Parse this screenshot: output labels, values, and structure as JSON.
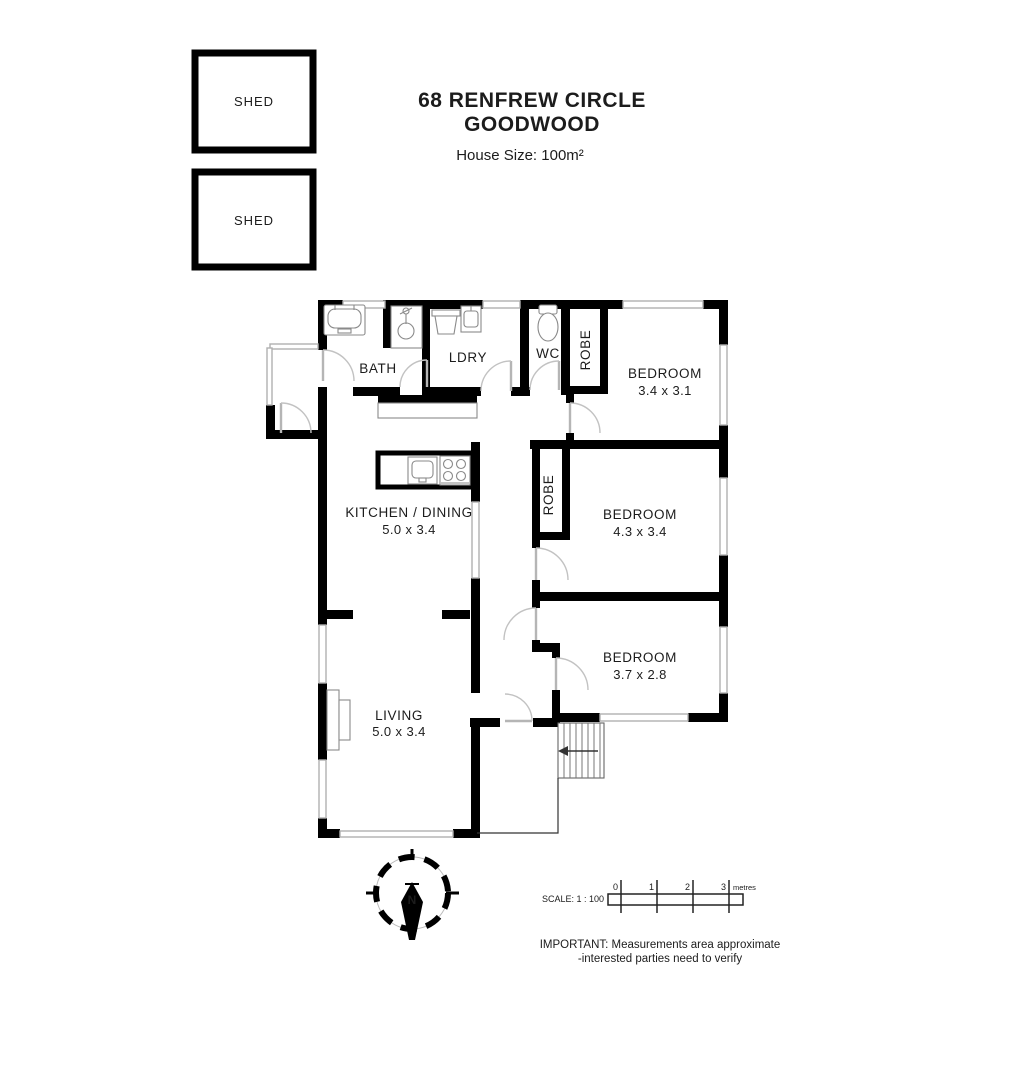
{
  "header": {
    "title_line1": "68 RENFREW CIRCLE",
    "title_line2": "GOODWOOD",
    "house_size": "House Size: 100m²"
  },
  "sheds": [
    {
      "label": "SHED"
    },
    {
      "label": "SHED"
    }
  ],
  "rooms": {
    "bath": {
      "label": "BATH"
    },
    "laundry": {
      "label": "LDRY"
    },
    "wc": {
      "label": "WC"
    },
    "robe1": {
      "label": "ROBE"
    },
    "robe2": {
      "label": "ROBE"
    },
    "bedroom1": {
      "label": "BEDROOM",
      "dims": "3.4 x 3.1"
    },
    "bedroom2": {
      "label": "BEDROOM",
      "dims": "4.3 x 3.4"
    },
    "bedroom3": {
      "label": "BEDROOM",
      "dims": "3.7 x 2.8"
    },
    "kitchen": {
      "label": "KITCHEN / DINING",
      "dims": "5.0 x 3.4"
    },
    "living": {
      "label": "LIVING",
      "dims": "5.0 x 3.4"
    }
  },
  "compass": {
    "north_label": "N"
  },
  "scale_bar": {
    "label": "SCALE: 1 : 100",
    "ticks": [
      "0",
      "1",
      "2",
      "3"
    ],
    "unit": "metres"
  },
  "disclaimer": {
    "line1": "IMPORTANT: Measurements area approximate",
    "line2": "-interested parties need to verify"
  },
  "colors": {
    "wall": "#000000",
    "window": "#b0b0b0",
    "door_arc": "#c2c2c2",
    "background": "#ffffff",
    "text": "#1c1c1c"
  }
}
